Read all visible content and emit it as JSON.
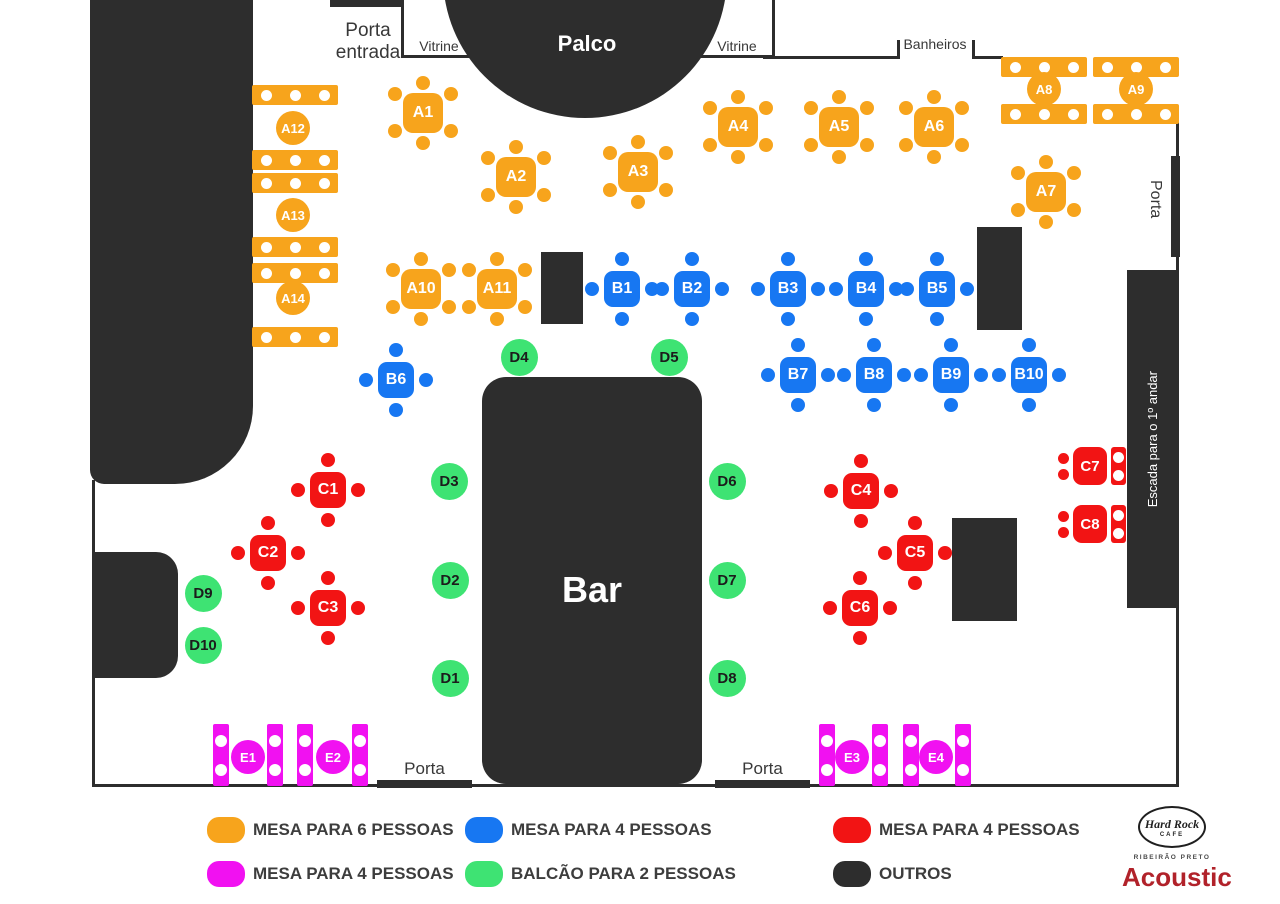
{
  "labels": {
    "porta_entrada": "Porta entrada",
    "vitrine": "Vitrine",
    "palco": "Palco",
    "banheiros": "Banheiros",
    "porta": "Porta",
    "escada": "Escada para o 1º andar",
    "bar": "Bar"
  },
  "colors": {
    "orange": "#F7A41C",
    "blue": "#1777F2",
    "red": "#F21414",
    "green": "#3EE373",
    "magenta": "#F111F1",
    "dark": "#2D2D2D",
    "acoustic": "#B1222A"
  },
  "tables": {
    "mesa6": [
      {
        "id": "A1",
        "x": 423,
        "y": 113
      },
      {
        "id": "A2",
        "x": 516,
        "y": 177
      },
      {
        "id": "A3",
        "x": 638,
        "y": 172
      },
      {
        "id": "A4",
        "x": 738,
        "y": 127
      },
      {
        "id": "A5",
        "x": 839,
        "y": 127
      },
      {
        "id": "A6",
        "x": 934,
        "y": 127
      },
      {
        "id": "A7",
        "x": 1046,
        "y": 192
      },
      {
        "id": "A10",
        "x": 421,
        "y": 289
      },
      {
        "id": "A11",
        "x": 497,
        "y": 289
      }
    ],
    "mesa6_bars": [
      {
        "id": "A8",
        "x": 1001,
        "y1": 57,
        "y2": 104,
        "lx": 1044,
        "ly": 89
      },
      {
        "id": "A9",
        "x": 1093,
        "y1": 57,
        "y2": 104,
        "lx": 1136,
        "ly": 89
      },
      {
        "id": "A12",
        "x": 252,
        "y1": 85,
        "y2": 150,
        "lx": 293,
        "ly": 128
      },
      {
        "id": "A13",
        "x": 252,
        "y1": 173,
        "y2": 237,
        "lx": 293,
        "ly": 215
      },
      {
        "id": "A14",
        "x": 252,
        "y1": 263,
        "y2": 327,
        "lx": 293,
        "ly": 298
      }
    ],
    "mesa4_blue": [
      {
        "id": "B1",
        "x": 622,
        "y": 289
      },
      {
        "id": "B2",
        "x": 692,
        "y": 289
      },
      {
        "id": "B3",
        "x": 788,
        "y": 289
      },
      {
        "id": "B4",
        "x": 866,
        "y": 289
      },
      {
        "id": "B5",
        "x": 937,
        "y": 289
      },
      {
        "id": "B6",
        "x": 396,
        "y": 380
      },
      {
        "id": "B7",
        "x": 798,
        "y": 375
      },
      {
        "id": "B8",
        "x": 874,
        "y": 375
      },
      {
        "id": "B9",
        "x": 951,
        "y": 375
      },
      {
        "id": "B10",
        "x": 1029,
        "y": 375
      }
    ],
    "mesa4_red": [
      {
        "id": "C1",
        "x": 328,
        "y": 490
      },
      {
        "id": "C2",
        "x": 268,
        "y": 553
      },
      {
        "id": "C3",
        "x": 328,
        "y": 608
      },
      {
        "id": "C4",
        "x": 861,
        "y": 491
      },
      {
        "id": "C5",
        "x": 915,
        "y": 553
      },
      {
        "id": "C6",
        "x": 860,
        "y": 608
      }
    ],
    "mesa4_red_wall": [
      {
        "id": "C7",
        "x": 1090,
        "y": 466
      },
      {
        "id": "C8",
        "x": 1090,
        "y": 524
      }
    ],
    "balcao2": [
      {
        "id": "D1",
        "x": 450,
        "y": 678
      },
      {
        "id": "D2",
        "x": 450,
        "y": 580
      },
      {
        "id": "D3",
        "x": 449,
        "y": 481
      },
      {
        "id": "D4",
        "x": 519,
        "y": 357
      },
      {
        "id": "D5",
        "x": 669,
        "y": 357
      },
      {
        "id": "D6",
        "x": 727,
        "y": 481
      },
      {
        "id": "D7",
        "x": 727,
        "y": 580
      },
      {
        "id": "D8",
        "x": 727,
        "y": 678
      },
      {
        "id": "D9",
        "x": 203,
        "y": 593
      },
      {
        "id": "D10",
        "x": 203,
        "y": 645
      }
    ],
    "mesa4_magenta": [
      {
        "id": "E1",
        "x1": 213,
        "x2": 267,
        "y": 724,
        "lx": 248,
        "ly": 757
      },
      {
        "id": "E2",
        "x1": 297,
        "x2": 352,
        "y": 724,
        "lx": 333,
        "ly": 757
      },
      {
        "id": "E3",
        "x1": 819,
        "x2": 872,
        "y": 724,
        "lx": 852,
        "ly": 757
      },
      {
        "id": "E4",
        "x1": 903,
        "x2": 955,
        "y": 724,
        "lx": 936,
        "ly": 757
      }
    ]
  },
  "legend": {
    "items": [
      {
        "color": "orange",
        "label": "MESA PARA 6 PESSOAS",
        "x": 207,
        "y": 817
      },
      {
        "color": "blue",
        "label": "MESA PARA 4 PESSOAS",
        "x": 465,
        "y": 817
      },
      {
        "color": "red",
        "label": "MESA PARA 4 PESSOAS",
        "x": 833,
        "y": 817
      },
      {
        "color": "magenta",
        "label": "MESA PARA 4 PESSOAS",
        "x": 207,
        "y": 861
      },
      {
        "color": "green",
        "label": "BALCÃO PARA 2 PESSOAS",
        "x": 465,
        "y": 861
      },
      {
        "color": "dark",
        "label": "OUTROS",
        "x": 833,
        "y": 861
      }
    ]
  },
  "brand": {
    "name": "Hard Rock",
    "cafe": "CAFE",
    "city": "RIBEIRÃO PRETO",
    "event": "Acoustic"
  }
}
